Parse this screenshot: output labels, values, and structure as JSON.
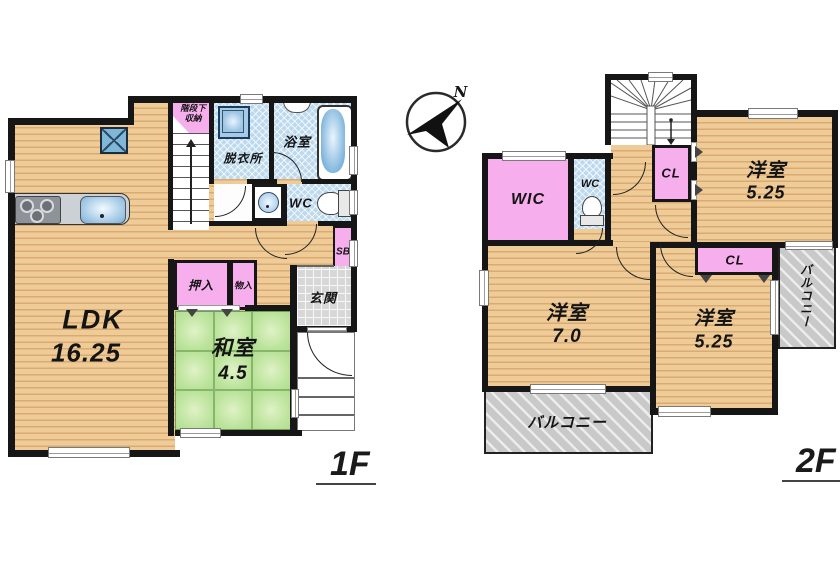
{
  "f1": {
    "title": "1F",
    "ldk_name": "LDK",
    "ldk_area": "16.25",
    "washitsu_name": "和室",
    "washitsu_area": "4.5",
    "oshiire": "押入",
    "monoire": "物入",
    "genkan": "玄関",
    "sb": "SB",
    "wc": "WC",
    "bath": "浴室",
    "dressing": "脱衣所",
    "understairs": "階段下収納"
  },
  "f2": {
    "title": "2F",
    "wic": "WIC",
    "wc": "WC",
    "cl_a": "CL",
    "cl_b": "CL",
    "room_ne_name": "洋室",
    "room_ne_area": "5.25",
    "room_sw_name": "洋室",
    "room_sw_area": "7.0",
    "room_se_name": "洋室",
    "room_se_area": "5.25",
    "balcony_south": "バルコニー",
    "balcony_east": "バルコニー"
  },
  "compass": {
    "north": "N"
  },
  "colors": {
    "wood": "#eecb97",
    "wood_stripe": "#d9ab72",
    "tatami_green": "#bde49e",
    "wet_blue": "#bdd9ee",
    "closet_pink": "#f7aeec",
    "balcony_gray": "#c9c9c9",
    "entrance_gray": "#d7d7d7",
    "wall": "#161616"
  }
}
